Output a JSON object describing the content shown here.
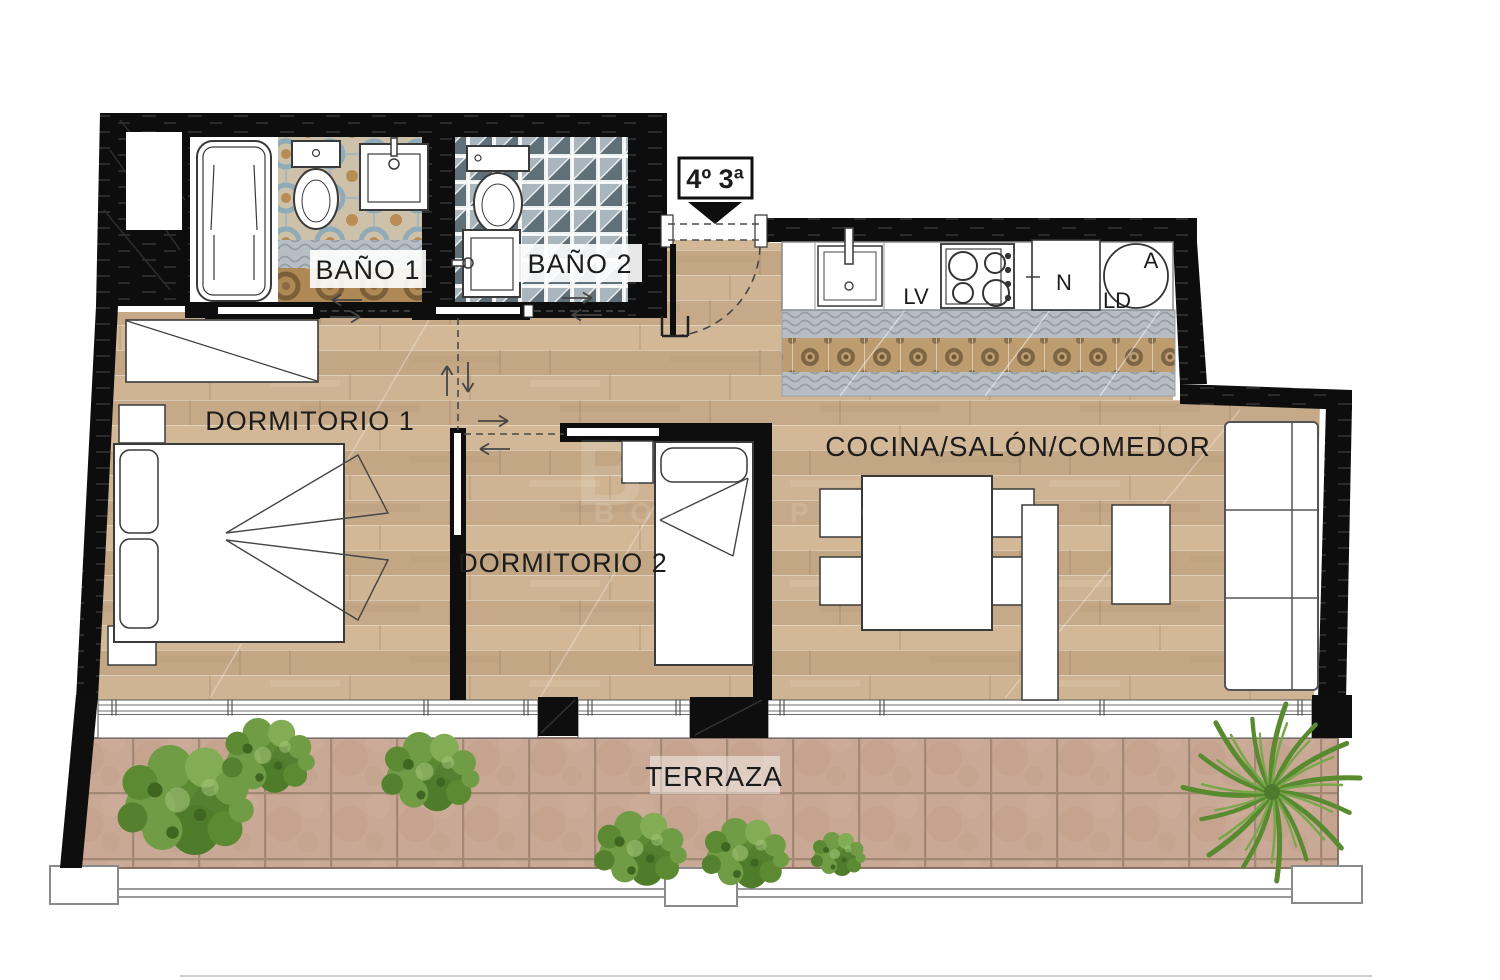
{
  "unit": {
    "label": "4º 3ª"
  },
  "rooms": {
    "bano1": "BAÑO 1",
    "bano2": "BAÑO 2",
    "dorm1": "DORMITORIO 1",
    "dorm2": "DORMITORIO 2",
    "salon": "COCINA/SALÓN/COMEDOR",
    "terraza": "TERRAZA"
  },
  "kitchen": {
    "dishwasher": "LV",
    "fridge": "N",
    "drum": "A",
    "laundry": "LD"
  },
  "watermark": {
    "big": "B",
    "left": "BOU",
    "right": "PRO"
  },
  "colors": {
    "wall": "#0e0e0e",
    "wood": "#ccb190",
    "terrace_tile": "#c5a28e",
    "plant_green": "#5c8a33",
    "bath1_blue": "#8fadbb",
    "bath2_slate": "#5f7078",
    "fixture_stroke": "#3a3a3a"
  }
}
